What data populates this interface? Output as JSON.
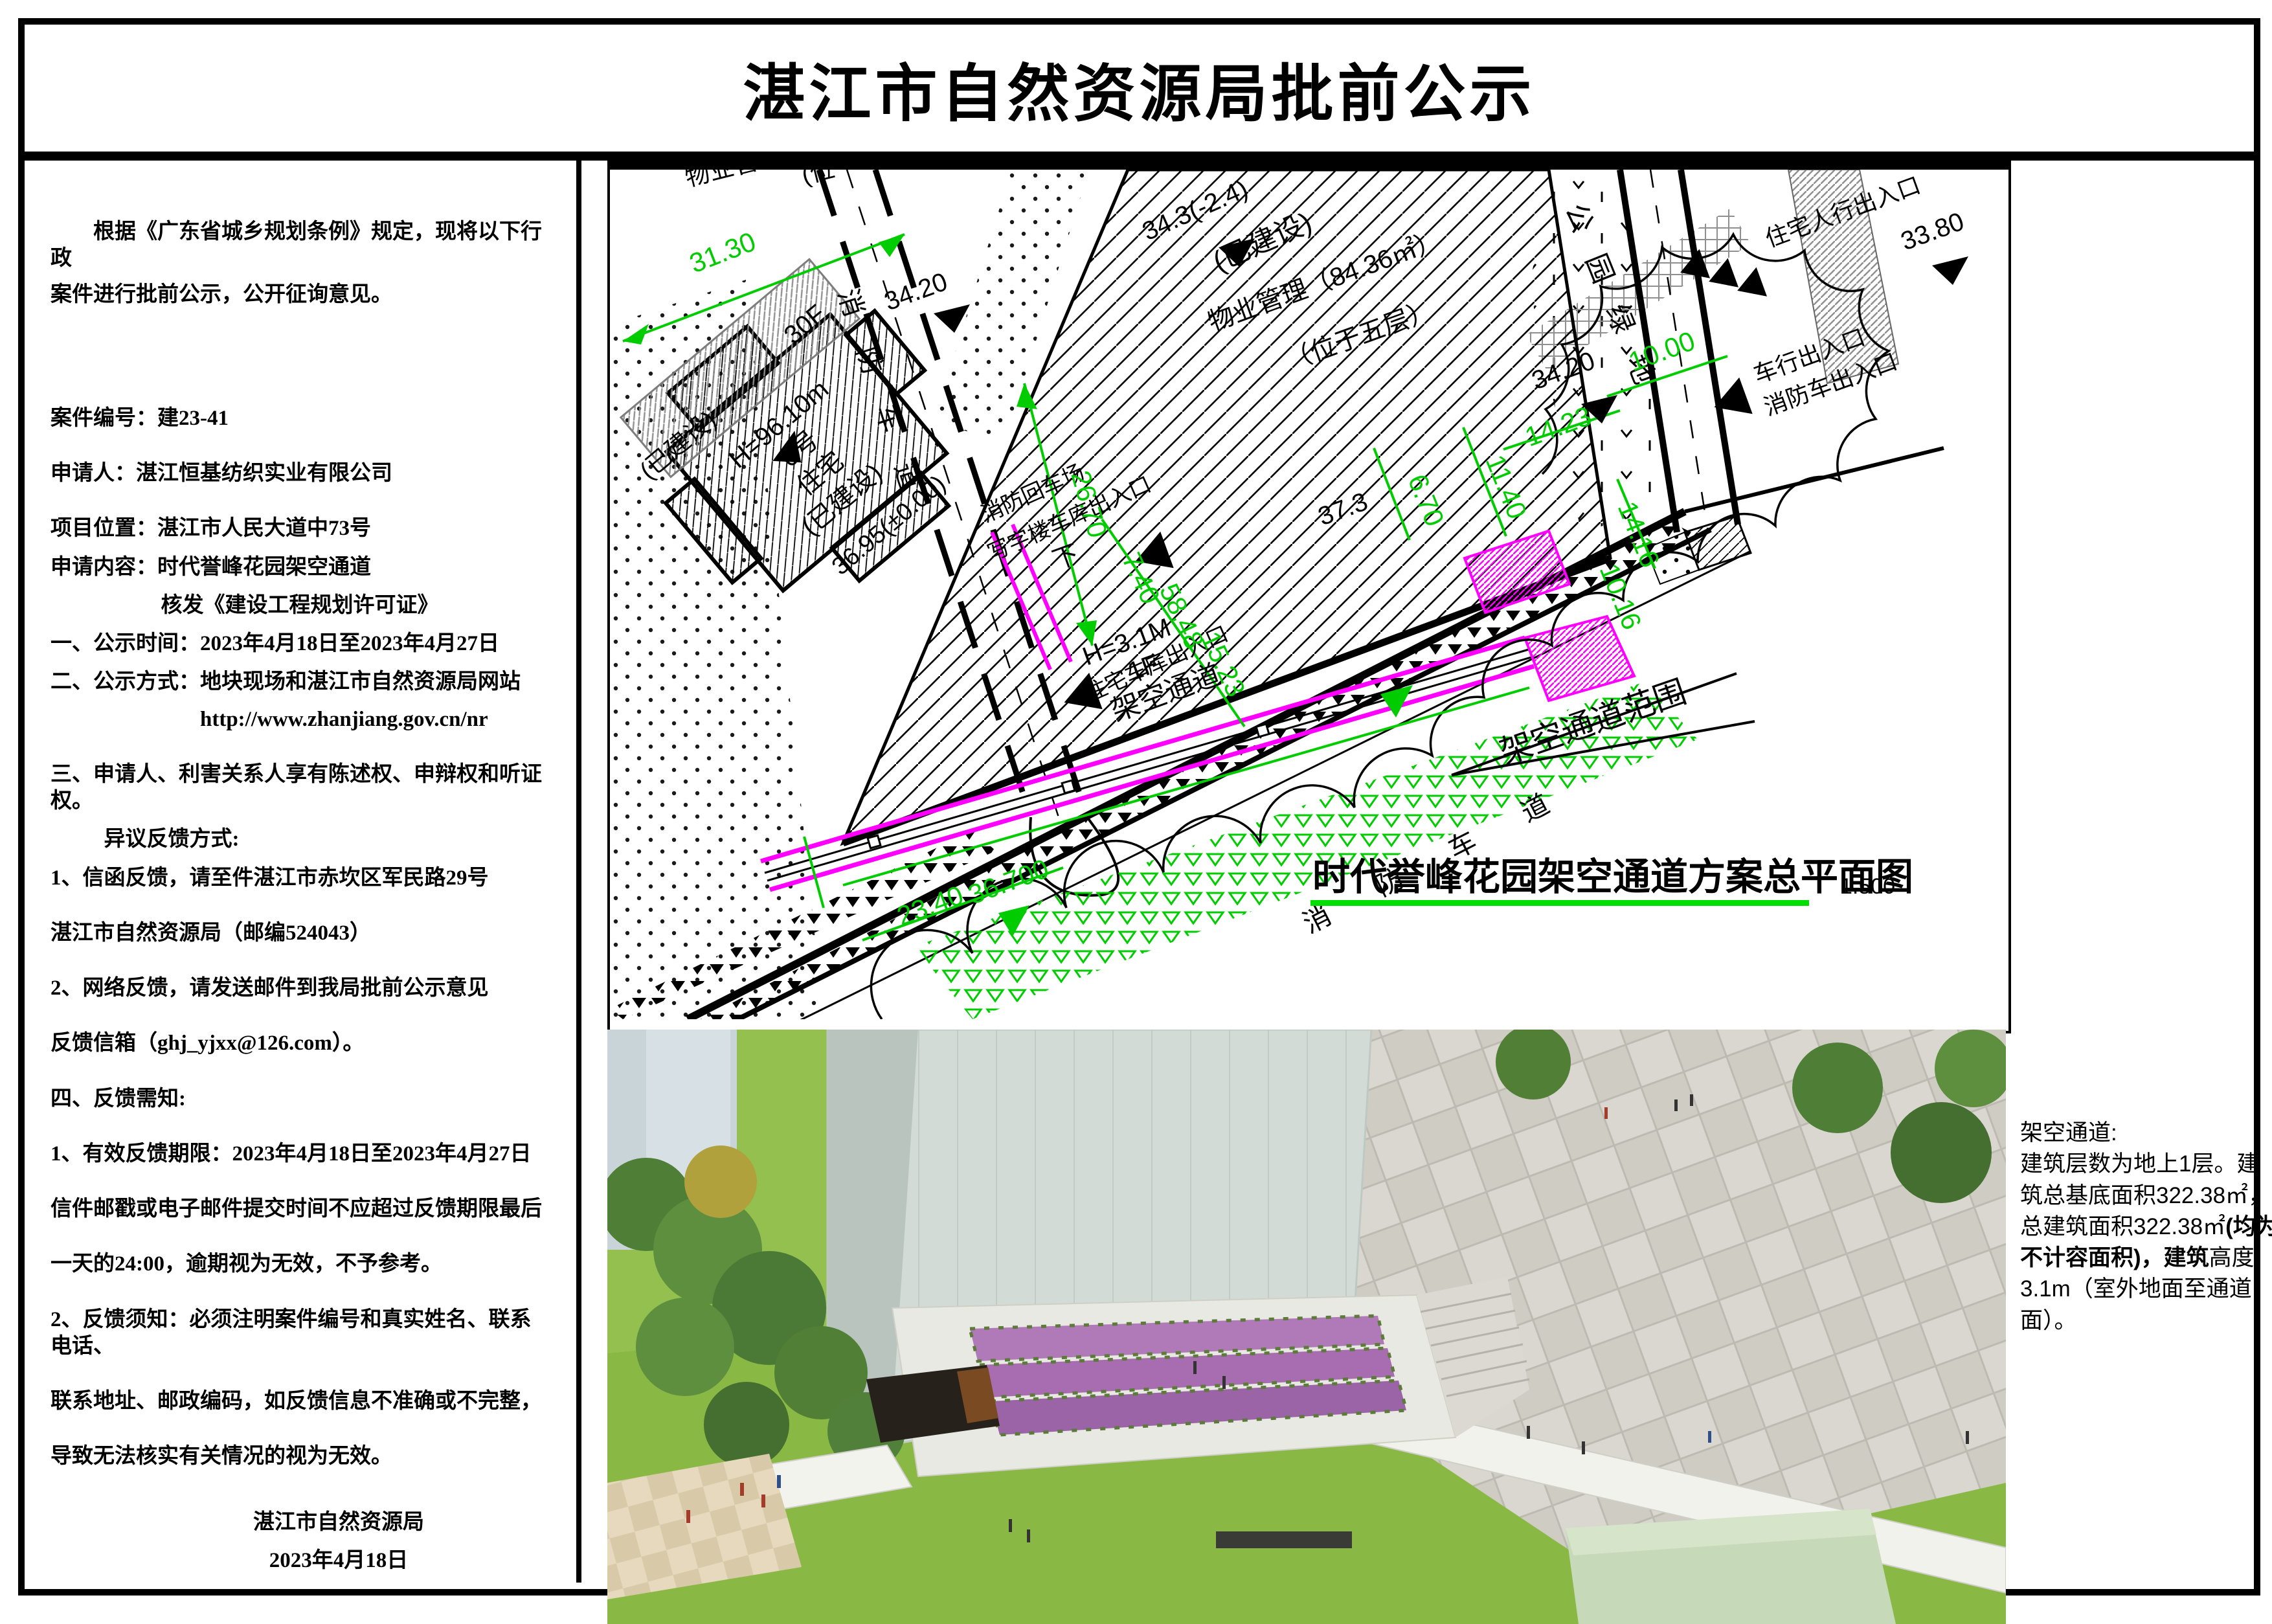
{
  "title": "湛江市自然资源局批前公示",
  "notice": {
    "intro_line1": "根据《广东省城乡规划条例》规定，现将以下行政",
    "intro_line2": "案件进行批前公示，公开征询意见。",
    "case_no": "案件编号：建23-41",
    "applicant": "申请人：湛江恒基纺织实业有限公司",
    "location": "项目位置：湛江市人民大道中73号",
    "content": "申请内容：时代誉峰花园架空通道",
    "permit": "核发《建设工程规划许可证》",
    "item1": "一、公示时间：2023年4月18日至2023年4月27日",
    "item2": "二、公示方式：地块现场和湛江市自然资源局网站",
    "item2_url": "http://www.zhanjiang.gov.cn/nr",
    "item3_line1": "三、申请人、利害关系人享有陈述权、申辩权和听证权。",
    "item3_line2": "异议反馈方式:",
    "feedback1_line1": "1、信函反馈，请至件湛江市赤坎区军民路29号",
    "feedback1_line2": "湛江市自然资源局（邮编524043）",
    "feedback2_line1": "2、网络反馈，请发送邮件到我局批前公示意见",
    "feedback2_line2": "反馈信箱（ghj_yjxx@126.com）。",
    "item4": "四、反馈需知:",
    "note1_line1": "1、有效反馈期限：2023年4月18日至2023年4月27日",
    "note1_line2": "信件邮戳或电子邮件提交时间不应超过反馈期限最后",
    "note1_line3": "一天的24:00，逾期视为无效，不予参考。",
    "note2_line1": "2、反馈须知：必须注明案件编号和真实姓名、联系电话、",
    "note2_line2": "联系地址、邮政编码，如反馈信息不准确或不完整，",
    "note2_line3": "导致无法核实有关情况的视为无效。",
    "signature": "湛江市自然资源局",
    "date": "2023年4月18日"
  },
  "plan": {
    "caption": "时代誉峰花园架空通道方案总平面图",
    "scale": "1:500",
    "range_label": "架空通道范围",
    "labels": {
      "top_partial_a": "物业管",
      "top_partial_b": "(位",
      "built_a": "(已建设)",
      "built_b": "(已建设)",
      "built_c": "(已建设)",
      "mgmt_line1": "物业管理（84.36㎡）",
      "mgmt_line2": "（位于五层）",
      "bldg_height": "H=96.10m",
      "bldg_no": "6号",
      "bldg_use": "住宅",
      "bldg_floors": "30F",
      "passage_h": "H=3.1M",
      "passage_floor": "1F",
      "passage_name": "架空通道",
      "fire_lane_left": "消防车道",
      "fire_lane_bottom": "消防车道",
      "fire_turnaround": "消防回车场",
      "office_garage_entry": "写字楼车库出入口",
      "res_garage_entry": "住宅车库出入口",
      "res_ped_entry": "住宅人行出入口",
      "vehicle_entry": "车行出入口",
      "fire_truck_entry": "消防车出入口",
      "park_green": "公园绿地",
      "down": "下",
      "level_36950": "36.95(±0.00)",
      "level_3420a": "34.20",
      "level_3420b": "34.20",
      "level_343": "34.3(-2.4)",
      "level_3380": "33.80",
      "level_373": "37.3",
      "level_36700": "36.700"
    },
    "dims": {
      "d3130": "31.30",
      "d2670": "26.70",
      "d2340": "23.40",
      "d740": "7.40",
      "d5848": "58.48",
      "d1523": "15.23",
      "d670": "6.70",
      "d1140": "11.40",
      "d1000": "10.00",
      "d1423": "14.23",
      "d1416": "14.16",
      "d1016": "10.16"
    }
  },
  "side_note": {
    "title": "架空通道:",
    "seg1": "建筑层数为地上1层。建筑总基底面积322.38㎡，总建筑面积322.38㎡",
    "seg2": "(均为不计容面积)，",
    "seg3": "建筑",
    "seg4": "高度3.1m（室外地面至通道面）。"
  },
  "colors": {
    "cad_green": "#00cc00",
    "cad_magenta": "#ff00ff",
    "hatch_gray": "#999999"
  }
}
